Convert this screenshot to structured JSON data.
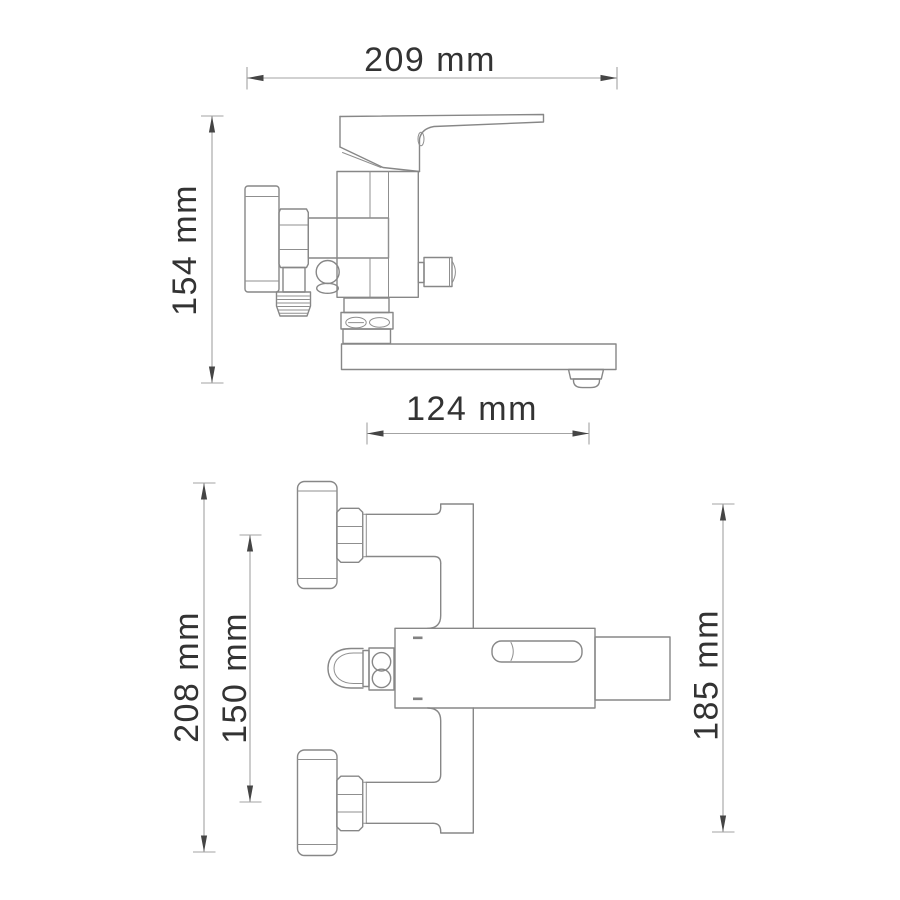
{
  "page": {
    "background": "#ffffff"
  },
  "colors": {
    "part_outline": "#878787",
    "dimension_line": "#a3a3a3",
    "arrow": "#454545",
    "label_text": "#333333"
  },
  "side_view": {
    "dim_width": "209 mm",
    "dim_height": "154 mm",
    "dim_spout": "124 mm"
  },
  "front_view": {
    "dim_total_height": "208 mm",
    "dim_connection_centers": "150 mm",
    "dim_right_height": "185 mm"
  }
}
